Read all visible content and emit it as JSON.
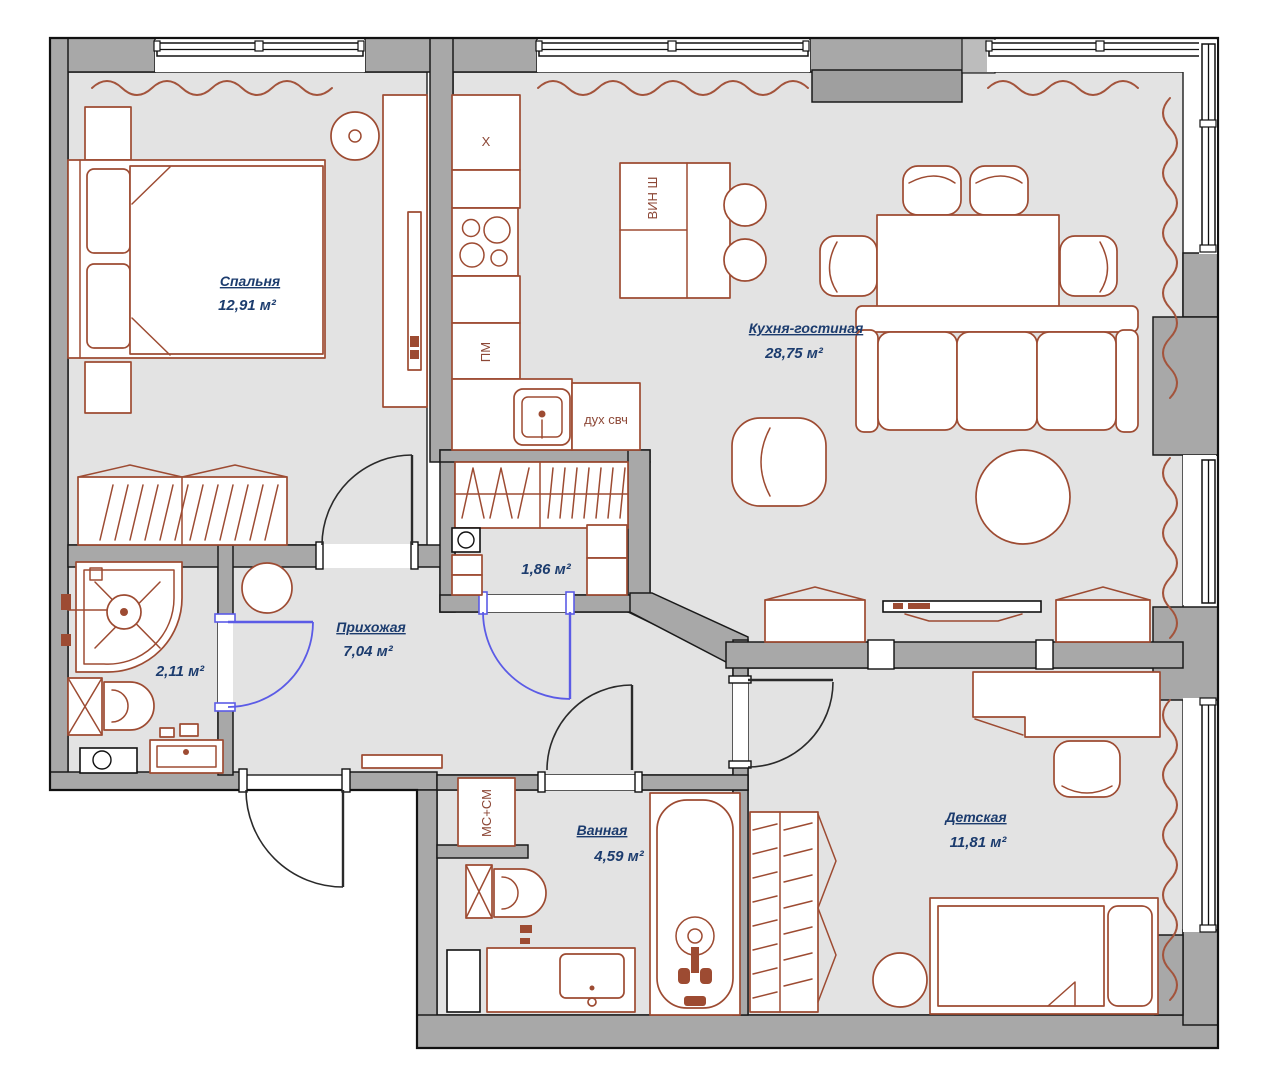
{
  "plan": {
    "rooms": {
      "bedroom": {
        "name": "Спальня",
        "area": "12,91 м²"
      },
      "kitchen_living": {
        "name": "Кухня-гостиная",
        "area": "28,75 м²"
      },
      "hallway": {
        "name": "Прихожая",
        "area": "7,04 м²"
      },
      "wardrobe": {
        "area": "1,86 м²"
      },
      "shower_room": {
        "area": "2,11 м²"
      },
      "bathroom": {
        "name": "Ванная",
        "area": "4,59 м²"
      },
      "kids_room": {
        "name": "Детская",
        "area": "11,81 м²"
      }
    },
    "appliances": {
      "fridge": "Х",
      "dishwasher": "ПМ",
      "oven_microwave": "дух свч",
      "wine_cabinet": "ВИН Ш",
      "washer_dryer": "МС+СМ"
    },
    "colors": {
      "wall": "#a8a8a8",
      "floor": "#e3e3e3",
      "furniture_outline": "#9d4b32",
      "label_text": "#1c3c6e",
      "interior_door": "#5b5be6",
      "entry_door": "#2a2a2a"
    }
  }
}
